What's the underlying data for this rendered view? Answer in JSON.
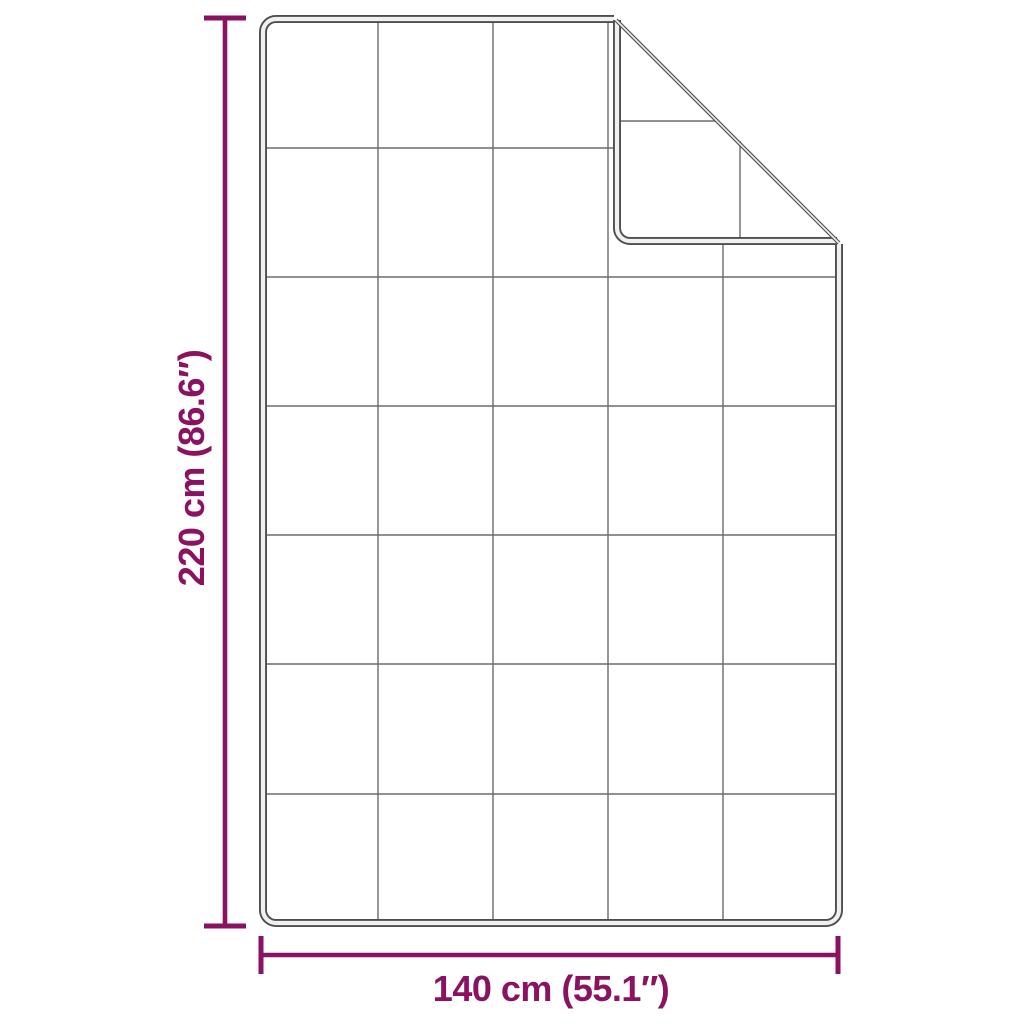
{
  "diagram": {
    "height_label": "220 cm (86.6″)",
    "width_label": "140 cm (55.1″)",
    "grid": {
      "columns": 5,
      "rows": 7,
      "folded_corner": "top-right"
    },
    "colors": {
      "dimension": "#8b1260",
      "outline_dark": "#4e4e4e",
      "outline_light": "#f0f0f0",
      "grid": "#6b6b6b",
      "crease": "#555555",
      "background": "#ffffff"
    }
  }
}
